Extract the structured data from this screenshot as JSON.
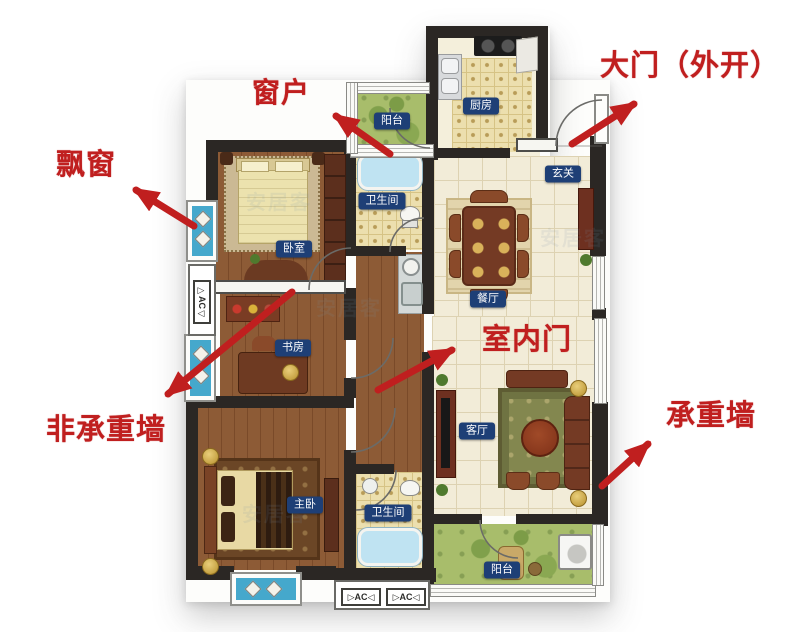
{
  "image_type": "floorplan-annotation-diagram",
  "watermark": "安居客",
  "annotations": [
    {
      "id": "window",
      "label": "窗户"
    },
    {
      "id": "main-door",
      "label": "大门（外开）"
    },
    {
      "id": "bay-window",
      "label": "飘窗"
    },
    {
      "id": "non-load-bearing-wall",
      "label": "非承重墙"
    },
    {
      "id": "interior-door",
      "label": "室内门"
    },
    {
      "id": "load-bearing-wall",
      "label": "承重墙"
    }
  ],
  "rooms": [
    {
      "id": "balcony-top",
      "label": "阳台"
    },
    {
      "id": "kitchen",
      "label": "厨房"
    },
    {
      "id": "foyer",
      "label": "玄关"
    },
    {
      "id": "bathroom-top",
      "label": "卫生间"
    },
    {
      "id": "bedroom",
      "label": "卧室"
    },
    {
      "id": "dining-room",
      "label": "餐厅"
    },
    {
      "id": "study",
      "label": "书房"
    },
    {
      "id": "living-room",
      "label": "客厅"
    },
    {
      "id": "master-bedroom",
      "label": "主卧"
    },
    {
      "id": "bathroom-bottom",
      "label": "卫生间"
    },
    {
      "id": "balcony-bottom",
      "label": "阳台"
    }
  ],
  "ac_units": [
    {
      "id": "ac-left",
      "label": "▷AC◁"
    },
    {
      "id": "ac-bottom-1",
      "label": "▷AC◁"
    },
    {
      "id": "ac-bottom-2",
      "label": "▷AC◁"
    }
  ],
  "colors": {
    "annotation_red": "#c01f1f",
    "badge_navy": "#1e3f76",
    "wall_dark": "#2b2724",
    "bay_window_blue": "#45a8cc",
    "balcony_green": "#a8bd6b",
    "wood_floor": "#8d5b36",
    "tile_beige": "#f2ecd8",
    "kitchen_tile": "#ecdfae",
    "furniture_brown": "#743a24"
  }
}
